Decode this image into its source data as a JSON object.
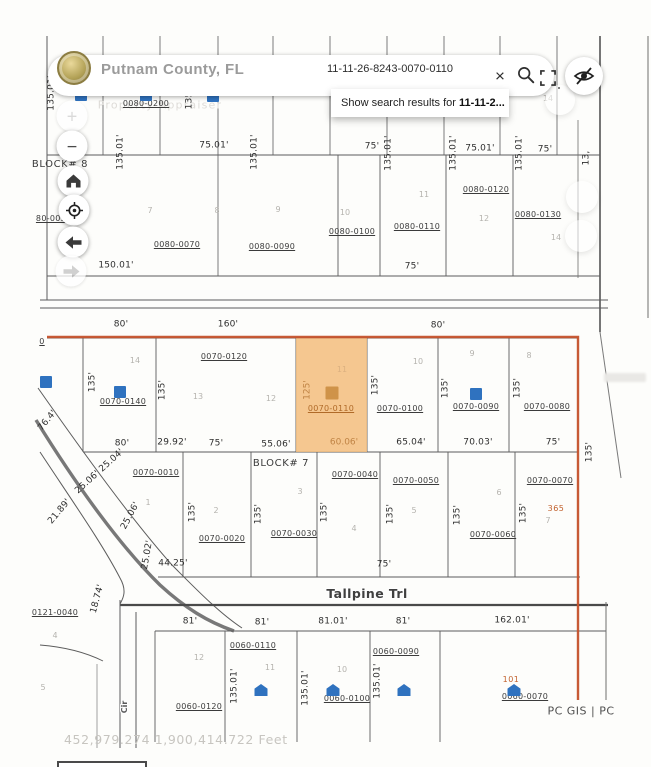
{
  "header": {
    "county_name": "Putnam County, FL",
    "search_value": "11-11-26-8243-0070-0110",
    "close_glyph": "×",
    "suggestion_prefix": "Show search results for",
    "suggestion_term": "11-11-2..."
  },
  "toolbar": {
    "zoom_in": "+",
    "zoom_out": "−"
  },
  "map": {
    "watermark": "Property Appraiser",
    "blocks": [
      "BLOCK# 8",
      "BLOCK# 7"
    ],
    "street_main": "Tallpine Trl",
    "street_side": "Cir",
    "attribution": "PC GIS | PC",
    "status_coordinates": "452,979.274 1,900,414.722 Feet",
    "highlight_parcel": {
      "id": "0070-0110",
      "lot": "11",
      "depth": "125'",
      "frontage": "60.06'"
    },
    "notes": {
      "n1": "365",
      "n2": "101"
    },
    "parcel_ids": [
      "0080-0200",
      "80-005",
      "0080-0070",
      "0080-0090",
      "0080-0100",
      "0080-0110",
      "0080-0120",
      "0080-0130",
      "0",
      "0070-0140",
      "0070-0120",
      "0070-0100",
      "0070-0090",
      "0070-0080",
      "0070-0010",
      "0070-0020",
      "0070-0030",
      "0070-0040",
      "0070-0050",
      "0070-0060",
      "0070-0070",
      "0121-0040",
      "0060-0120",
      "0060-0110",
      "0060-0100",
      "0060-0090",
      "0060-0070"
    ],
    "dims": [
      "135.01'",
      "135.0",
      "75.01'",
      "135.01'",
      "135.01'",
      "75'",
      "135.01'",
      "75.01'",
      "135.01'",
      "135.01'",
      "75'",
      "13,",
      "150.01'",
      "75'",
      "80'",
      "160'",
      "80'",
      "135'",
      "135'",
      "135'",
      "135'",
      "135'",
      "80'",
      "29.92'",
      "75'",
      "55.06'",
      "65.04'",
      "70.03'",
      "75'",
      "76.4'",
      "135'",
      "135'",
      "135'",
      "135'",
      "135'",
      "135'",
      "44.25'",
      "75'",
      "25.06' 25.04'",
      "21.89'",
      "25.06'",
      "25.02'",
      "18.74'",
      "135'",
      "81'",
      "81'",
      "81.01'",
      "81'",
      "162.01'",
      "135.01'",
      "135.01'",
      "135.01'"
    ],
    "lots": [
      "19",
      "14",
      "7",
      "8",
      "9",
      "10",
      "11",
      "12",
      "14",
      "14",
      "13",
      "12",
      "10",
      "9",
      "8",
      "1",
      "2",
      "3",
      "4",
      "5",
      "6",
      "7",
      "4",
      "5",
      "12",
      "11",
      "10"
    ]
  },
  "colors": {
    "selection_boundary": "#c4512b",
    "highlight_fill": "#f3bd7d",
    "structure_blue": "#2f72bf",
    "accent_orange_label": "#b06a28"
  }
}
